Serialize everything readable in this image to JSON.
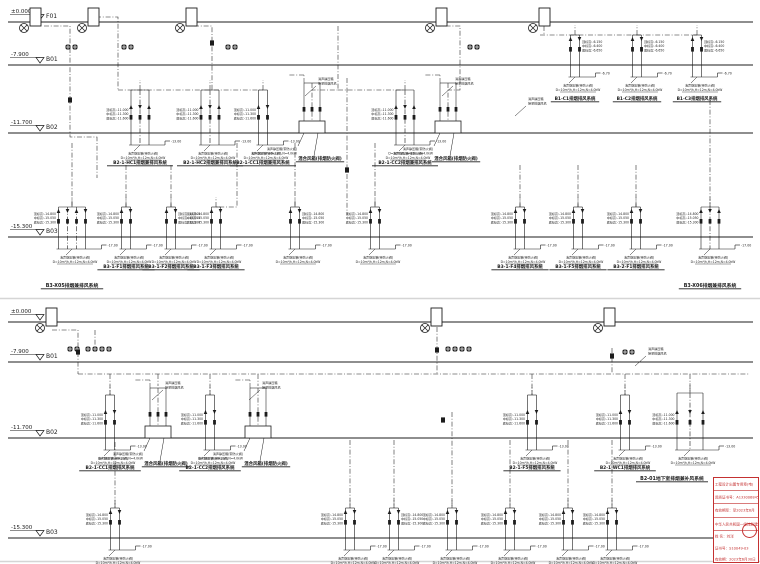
{
  "page": {
    "width": 760,
    "height": 564,
    "background": "#ffffff",
    "line_color": "#1c1c1c",
    "level_line_color": "#2a2a2a",
    "separator_color": "#d5d5d5",
    "accent_red": "#c43131"
  },
  "annotations": {
    "elev_cluster": {
      "b01": [
        "顶标高:-6.150",
        "中标高:-6.400",
        "底标高:-6.650"
      ],
      "b02": [
        "顶标高:-11.000",
        "中标高:-11.300",
        "底标高:-11.600"
      ],
      "b03": [
        "顶标高:-14.800",
        "中标高:-15.050",
        "底标高:-15.300"
      ]
    },
    "elev_tag": {
      "b01": "-6.70",
      "b02": "-13.00",
      "b03": "-17.00"
    },
    "spec_box": [
      "消声静压箱(带防火阀)",
      "D=10m³/h,H=12m,N=4.0kW"
    ],
    "leader_note": [
      "消声静压箱",
      "接至排烟风机"
    ],
    "box_label": "混合风箱(排烟防火阀)"
  },
  "diagrams": [
    {
      "id": "upper",
      "levels": [
        {
          "elev": "±0.000",
          "name": "F01",
          "y": 22
        },
        {
          "elev": "-7.900",
          "name": "B01",
          "y": 65
        },
        {
          "elev": "-11.700",
          "name": "B02",
          "y": 133
        },
        {
          "elev": "-15.300",
          "name": "B03",
          "y": 237
        }
      ],
      "separator_y": 298.5,
      "fans": [
        {
          "x": 24
        },
        {
          "x": 82
        },
        {
          "x": 180
        },
        {
          "x": 430
        },
        {
          "x": 533
        }
      ],
      "valve_rows": [
        {
          "x": 68,
          "y": 47,
          "n": 2
        },
        {
          "x": 124,
          "y": 47,
          "n": 2
        },
        {
          "x": 228,
          "y": 47,
          "n": 2
        },
        {
          "x": 470,
          "y": 47,
          "n": 2
        }
      ],
      "inline_dampers": [
        {
          "x": 70,
          "y": 100
        },
        {
          "x": 212,
          "y": 43
        },
        {
          "x": 347,
          "y": 170
        }
      ],
      "routes": [
        [
          [
            44,
            26
          ],
          [
            70,
            26
          ],
          [
            70,
            137
          ],
          [
            97,
            137
          ],
          [
            97,
            178
          ]
        ],
        [
          [
            96,
            17
          ],
          [
            118,
            17
          ],
          [
            118,
            90
          ]
        ],
        [
          [
            118,
            90
          ],
          [
            263,
            90
          ]
        ],
        [
          [
            194,
            26
          ],
          [
            212,
            26
          ],
          [
            212,
            90
          ]
        ],
        [
          [
            338,
            26
          ],
          [
            338,
            90
          ],
          [
            312,
            90
          ]
        ],
        [
          [
            338,
            90
          ],
          [
            405,
            90
          ]
        ],
        [
          [
            436,
            26
          ],
          [
            460,
            26
          ],
          [
            460,
            90
          ],
          [
            448,
            90
          ]
        ],
        [
          [
            544,
            26
          ],
          [
            544,
            35
          ]
        ],
        [
          [
            540,
            35
          ],
          [
            697,
            35
          ]
        ],
        [
          [
            347,
            78
          ],
          [
            347,
            215
          ]
        ],
        [
          [
            237,
            143
          ],
          [
            237,
            207
          ],
          [
            216,
            207
          ]
        ],
        [
          [
            126,
            165
          ],
          [
            126,
            207
          ]
        ],
        [
          [
            171,
            165
          ],
          [
            171,
            207
          ]
        ],
        [
          [
            520,
            165
          ],
          [
            520,
            207
          ]
        ],
        [
          [
            578,
            165
          ],
          [
            578,
            207
          ]
        ],
        [
          [
            636,
            165
          ],
          [
            636,
            207
          ]
        ],
        [
          [
            295,
            143
          ],
          [
            295,
            207
          ]
        ],
        [
          [
            375,
            143
          ],
          [
            375,
            207
          ]
        ],
        [
          [
            72,
            143
          ],
          [
            72,
            207
          ]
        ],
        [
          [
            710,
            100
          ],
          [
            710,
            207
          ]
        ]
      ],
      "groups": [
        {
          "cx": 575,
          "line": 65,
          "n": 2,
          "rise": 30,
          "elevs": "b01",
          "side": "right",
          "label": "B1-C1排烟排风系统",
          "dy": 35
        },
        {
          "cx": 637,
          "line": 65,
          "n": 2,
          "rise": 30,
          "elevs": "b01",
          "side": "right",
          "label": "B1-C2排烟排风系统",
          "dy": 35
        },
        {
          "cx": 697,
          "line": 65,
          "n": 2,
          "rise": 30,
          "elevs": "b01",
          "side": "right",
          "label": "B1-C3排烟排风系统",
          "dy": 35
        },
        {
          "cx": 140,
          "line": 133,
          "n": 3,
          "rise": 43,
          "elevs": "b02",
          "side": "left",
          "label": "B2-1-HC1排烟兼排风系统"
        },
        {
          "cx": 210,
          "line": 133,
          "n": 3,
          "rise": 43,
          "elevs": "b02",
          "side": "left",
          "label": "B2-1-HC2排烟兼排风系统"
        },
        {
          "cx": 263,
          "line": 133,
          "n": 2,
          "rise": 43,
          "elevs": "b02",
          "side": "left",
          "label": "B2-1-CC1排烟兼排风系统"
        },
        {
          "cx": 405,
          "line": 133,
          "n": 3,
          "rise": 43,
          "elevs": "b02",
          "side": "left",
          "label": "B2-1-CC2排烟兼排风系统"
        },
        {
          "cx": 72,
          "line": 237,
          "n": 4,
          "rise": 30,
          "elevs": "b03",
          "side": "left",
          "label": "B3-X05排烟兼排风系统",
          "dy": 50,
          "bold": true
        },
        {
          "cx": 126,
          "line": 237,
          "n": 2,
          "rise": 30,
          "elevs": "b03",
          "side": "left",
          "label": "B3-1-F1排烟排风系统"
        },
        {
          "cx": 171,
          "line": 237,
          "n": 2,
          "rise": 30,
          "elevs": "b03",
          "side": "right",
          "label": "B3-1-F2排烟排风系统"
        },
        {
          "cx": 216,
          "line": 237,
          "n": 2,
          "rise": 30,
          "elevs": "b03",
          "side": "left",
          "label": "B3-1-F3排烟排风系统"
        },
        {
          "cx": 295,
          "line": 237,
          "n": 2,
          "rise": 30,
          "elevs": "b03",
          "side": "right"
        },
        {
          "cx": 375,
          "line": 237,
          "n": 2,
          "rise": 30,
          "elevs": "b03",
          "side": "left"
        },
        {
          "cx": 520,
          "line": 237,
          "n": 2,
          "rise": 30,
          "elevs": "b03",
          "side": "left",
          "label": "B3-1-F4排烟排风系统"
        },
        {
          "cx": 578,
          "line": 237,
          "n": 2,
          "rise": 30,
          "elevs": "b03",
          "side": "left",
          "label": "B3-1-F5排烟排风系统"
        },
        {
          "cx": 636,
          "line": 237,
          "n": 2,
          "rise": 30,
          "elevs": "b03",
          "side": "left",
          "label": "B3-2-F1排烟排风系统"
        },
        {
          "cx": 710,
          "line": 237,
          "n": 3,
          "rise": 30,
          "elevs": "b03",
          "side": "left",
          "label": "B3-X06排烟兼排风系统",
          "dy": 50,
          "bold": true
        }
      ],
      "boxes": [
        {
          "cx": 312,
          "line": 133
        },
        {
          "cx": 448,
          "line": 133
        }
      ],
      "notes": [
        {
          "x": 318,
          "y": 80
        },
        {
          "x": 455,
          "y": 80
        },
        {
          "x": 528,
          "y": 100
        }
      ]
    },
    {
      "id": "lower",
      "levels": [
        {
          "elev": "±0.000",
          "name": "F01",
          "y": 322
        },
        {
          "elev": "-7.900",
          "name": "B01",
          "y": 362
        },
        {
          "elev": "-11.700",
          "name": "B02",
          "y": 438
        },
        {
          "elev": "-15.300",
          "name": "B03",
          "y": 538
        }
      ],
      "separator_y": 561.5,
      "fans": [
        {
          "x": 40,
          "y": 322
        },
        {
          "x": 425,
          "y": 322
        },
        {
          "x": 598,
          "y": 322
        }
      ],
      "valve_rows": [
        {
          "x": 70,
          "y": 349,
          "n": 2
        },
        {
          "x": 88,
          "y": 349,
          "n": 4
        },
        {
          "x": 448,
          "y": 349,
          "n": 4
        },
        {
          "x": 625,
          "y": 352,
          "n": 2
        }
      ],
      "inline_dampers": [
        {
          "x": 78,
          "y": 352
        },
        {
          "x": 437,
          "y": 350
        },
        {
          "x": 612,
          "y": 356
        },
        {
          "x": 443,
          "y": 420
        }
      ],
      "routes": [
        [
          [
            52,
            330
          ],
          [
            78,
            330
          ],
          [
            78,
            374
          ]
        ],
        [
          [
            95,
            330
          ],
          [
            95,
            348
          ]
        ],
        [
          [
            78,
            374
          ],
          [
            750,
            374
          ]
        ],
        [
          [
            110,
            374
          ],
          [
            110,
            395
          ]
        ],
        [
          [
            158,
            374
          ],
          [
            158,
            386
          ]
        ],
        [
          [
            210,
            374
          ],
          [
            210,
            395
          ]
        ],
        [
          [
            258,
            374
          ],
          [
            258,
            386
          ]
        ],
        [
          [
            437,
            327
          ],
          [
            437,
            374
          ]
        ],
        [
          [
            612,
            348
          ],
          [
            612,
            374
          ]
        ],
        [
          [
            532,
            374
          ],
          [
            532,
            395
          ]
        ],
        [
          [
            625,
            374
          ],
          [
            625,
            395
          ]
        ],
        [
          [
            690,
            374
          ],
          [
            690,
            393
          ]
        ],
        [
          [
            350,
            440
          ],
          [
            350,
            508
          ]
        ],
        [
          [
            394,
            440
          ],
          [
            394,
            508
          ]
        ],
        [
          [
            452,
            412
          ],
          [
            452,
            508
          ]
        ],
        [
          [
            510,
            440
          ],
          [
            510,
            508
          ]
        ],
        [
          [
            568,
            440
          ],
          [
            568,
            508
          ]
        ],
        [
          [
            612,
            440
          ],
          [
            612,
            508
          ]
        ],
        [
          [
            115,
            442
          ],
          [
            115,
            508
          ]
        ]
      ],
      "groups": [
        {
          "cx": 110,
          "line": 438,
          "n": 2,
          "rise": 43,
          "elevs": "b02",
          "side": "left",
          "label": "B2-1-CC1排烟排风系统"
        },
        {
          "cx": 210,
          "line": 438,
          "n": 2,
          "rise": 43,
          "elevs": "b02",
          "side": "left",
          "label": "B2-1-CC2排烟排风系统"
        },
        {
          "cx": 532,
          "line": 438,
          "n": 2,
          "rise": 43,
          "elevs": "b02",
          "side": "left",
          "label": "B2-1-F5排烟排风系统"
        },
        {
          "cx": 625,
          "line": 438,
          "n": 2,
          "rise": 43,
          "elevs": "b02",
          "side": "left",
          "label": "B2-1-WC1排烟排风系统"
        },
        {
          "cx": 690,
          "line": 438,
          "n": 3,
          "sp": 13,
          "rise": 45,
          "elevs": "b02",
          "side": "left",
          "label": "B2-01地下室排烟兼补风系统",
          "dy": 42,
          "ldx": -18,
          "bold": true
        },
        {
          "cx": 115,
          "line": 538,
          "n": 2,
          "rise": 30,
          "elevs": "b03",
          "side": "left"
        },
        {
          "cx": 350,
          "line": 538,
          "n": 2,
          "rise": 30,
          "elevs": "b03",
          "side": "left"
        },
        {
          "cx": 394,
          "line": 538,
          "n": 2,
          "rise": 30,
          "elevs": "b03",
          "side": "right"
        },
        {
          "cx": 452,
          "line": 538,
          "n": 2,
          "rise": 30,
          "elevs": "b03",
          "side": "left"
        },
        {
          "cx": 510,
          "line": 538,
          "n": 2,
          "rise": 30,
          "elevs": "b03",
          "side": "left"
        },
        {
          "cx": 568,
          "line": 538,
          "n": 2,
          "rise": 30,
          "elevs": "b03",
          "side": "left"
        },
        {
          "cx": 612,
          "line": 538,
          "n": 2,
          "rise": 30,
          "elevs": "b03",
          "side": "left"
        }
      ],
      "boxes": [
        {
          "cx": 158,
          "line": 438
        },
        {
          "cx": 258,
          "line": 438
        }
      ],
      "notes": [
        {
          "x": 165,
          "y": 384
        },
        {
          "x": 262,
          "y": 384
        },
        {
          "x": 648,
          "y": 350
        }
      ]
    }
  ],
  "stamp": {
    "lines": [
      "工程设计出图专用章(电)",
      "资质证书号：A133006845",
      "有效期至：至2023年6月",
      "中华人民共和国一级注册建筑师",
      "姓 名：刘洋",
      "证书号：S10049-03",
      "有效期：2023年6月30日"
    ]
  }
}
